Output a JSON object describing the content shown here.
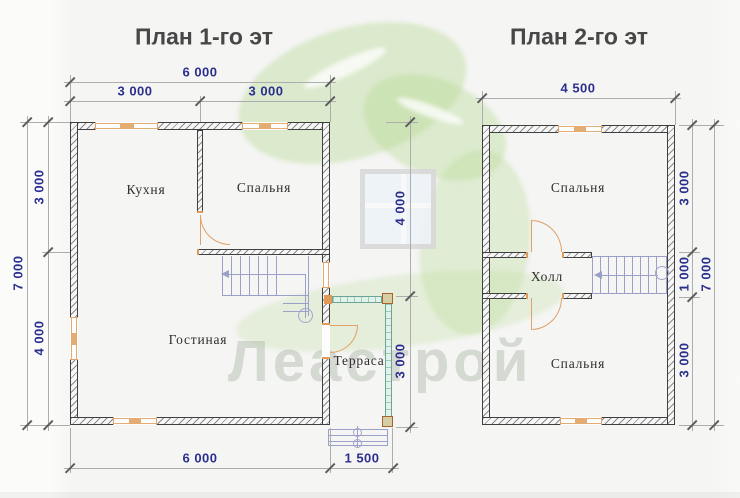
{
  "titles": {
    "floor1": "План 1-го эт",
    "floor2": "План 2-го эт"
  },
  "watermark": {
    "logo_text": "Леастрой"
  },
  "floor1": {
    "rooms": {
      "kitchen": "Кухня",
      "bedroom": "Спальня",
      "living_room": "Гостиная",
      "terrace": "Терраса"
    },
    "dimensions": {
      "top_total": "6 000",
      "top_left": "3 000",
      "top_right": "3 000",
      "left_total": "7 000",
      "left_upper": "3 000",
      "left_lower": "4 000",
      "bottom_total": "6 000",
      "terrace_width": "1 500",
      "middle_upper": "4 000",
      "terrace_depth": "3 000"
    }
  },
  "floor2": {
    "rooms": {
      "bedroom_top": "Спальня",
      "hall": "Холл",
      "bedroom_bottom": "Спальня"
    },
    "dimensions": {
      "top_total": "4 500",
      "right_upper": "3 000",
      "right_middle": "1 000",
      "right_lower": "3 000",
      "right_total": "7 000"
    }
  },
  "colors": {
    "dimension_text": "#2b2f8e",
    "wall_outline": "#3f3f3f",
    "joinery_orange": "#dfa269",
    "stairs_blue": "#9aa0c8",
    "terrace_green": "#6aa695",
    "watermark_green": "#b7d994"
  }
}
